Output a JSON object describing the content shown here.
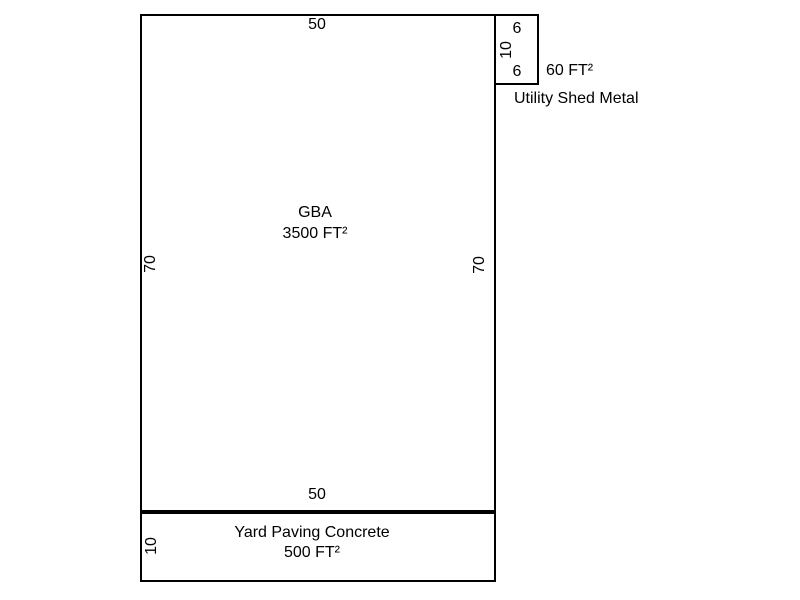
{
  "canvas": {
    "background": "#ffffff",
    "line_color": "#000000",
    "text_color": "#000000"
  },
  "gba": {
    "label": "GBA",
    "area": "3500 FT²",
    "dims": {
      "top": "50",
      "bottom": "50",
      "left": "70",
      "right": "70"
    }
  },
  "shed": {
    "label": "Utility Shed Metal",
    "area": "60 FT²",
    "dims": {
      "top": "6",
      "left": "10",
      "bottom": "6"
    }
  },
  "yard": {
    "label": "Yard Paving Concrete",
    "area": "500 FT²",
    "dims": {
      "left": "10"
    }
  }
}
